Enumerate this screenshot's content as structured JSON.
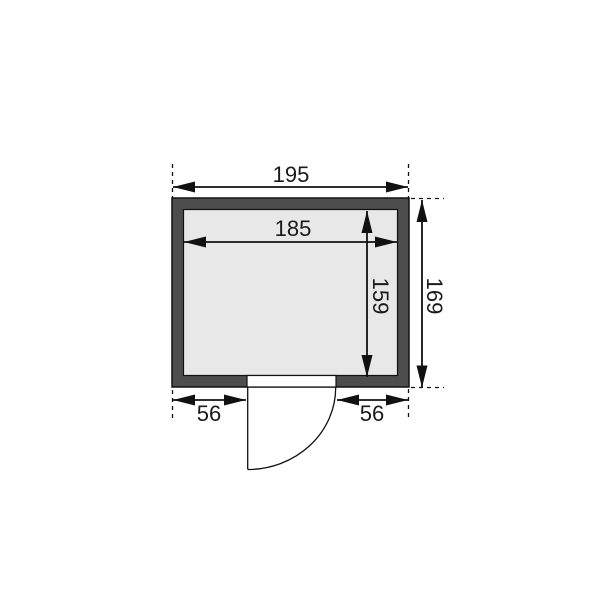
{
  "page": {
    "background": "#ffffff"
  },
  "diagram": {
    "colors": {
      "wall_fill": "#4d4d4d",
      "floor_fill": "#e8e8e8",
      "outline": "#111111",
      "label_text": "#1a1a1a"
    },
    "labels": {
      "outer_width": "195",
      "inner_width": "185",
      "inner_depth": "159",
      "outer_depth": "169",
      "door_clearance_left": "56",
      "door_clearance_right": "56"
    }
  }
}
